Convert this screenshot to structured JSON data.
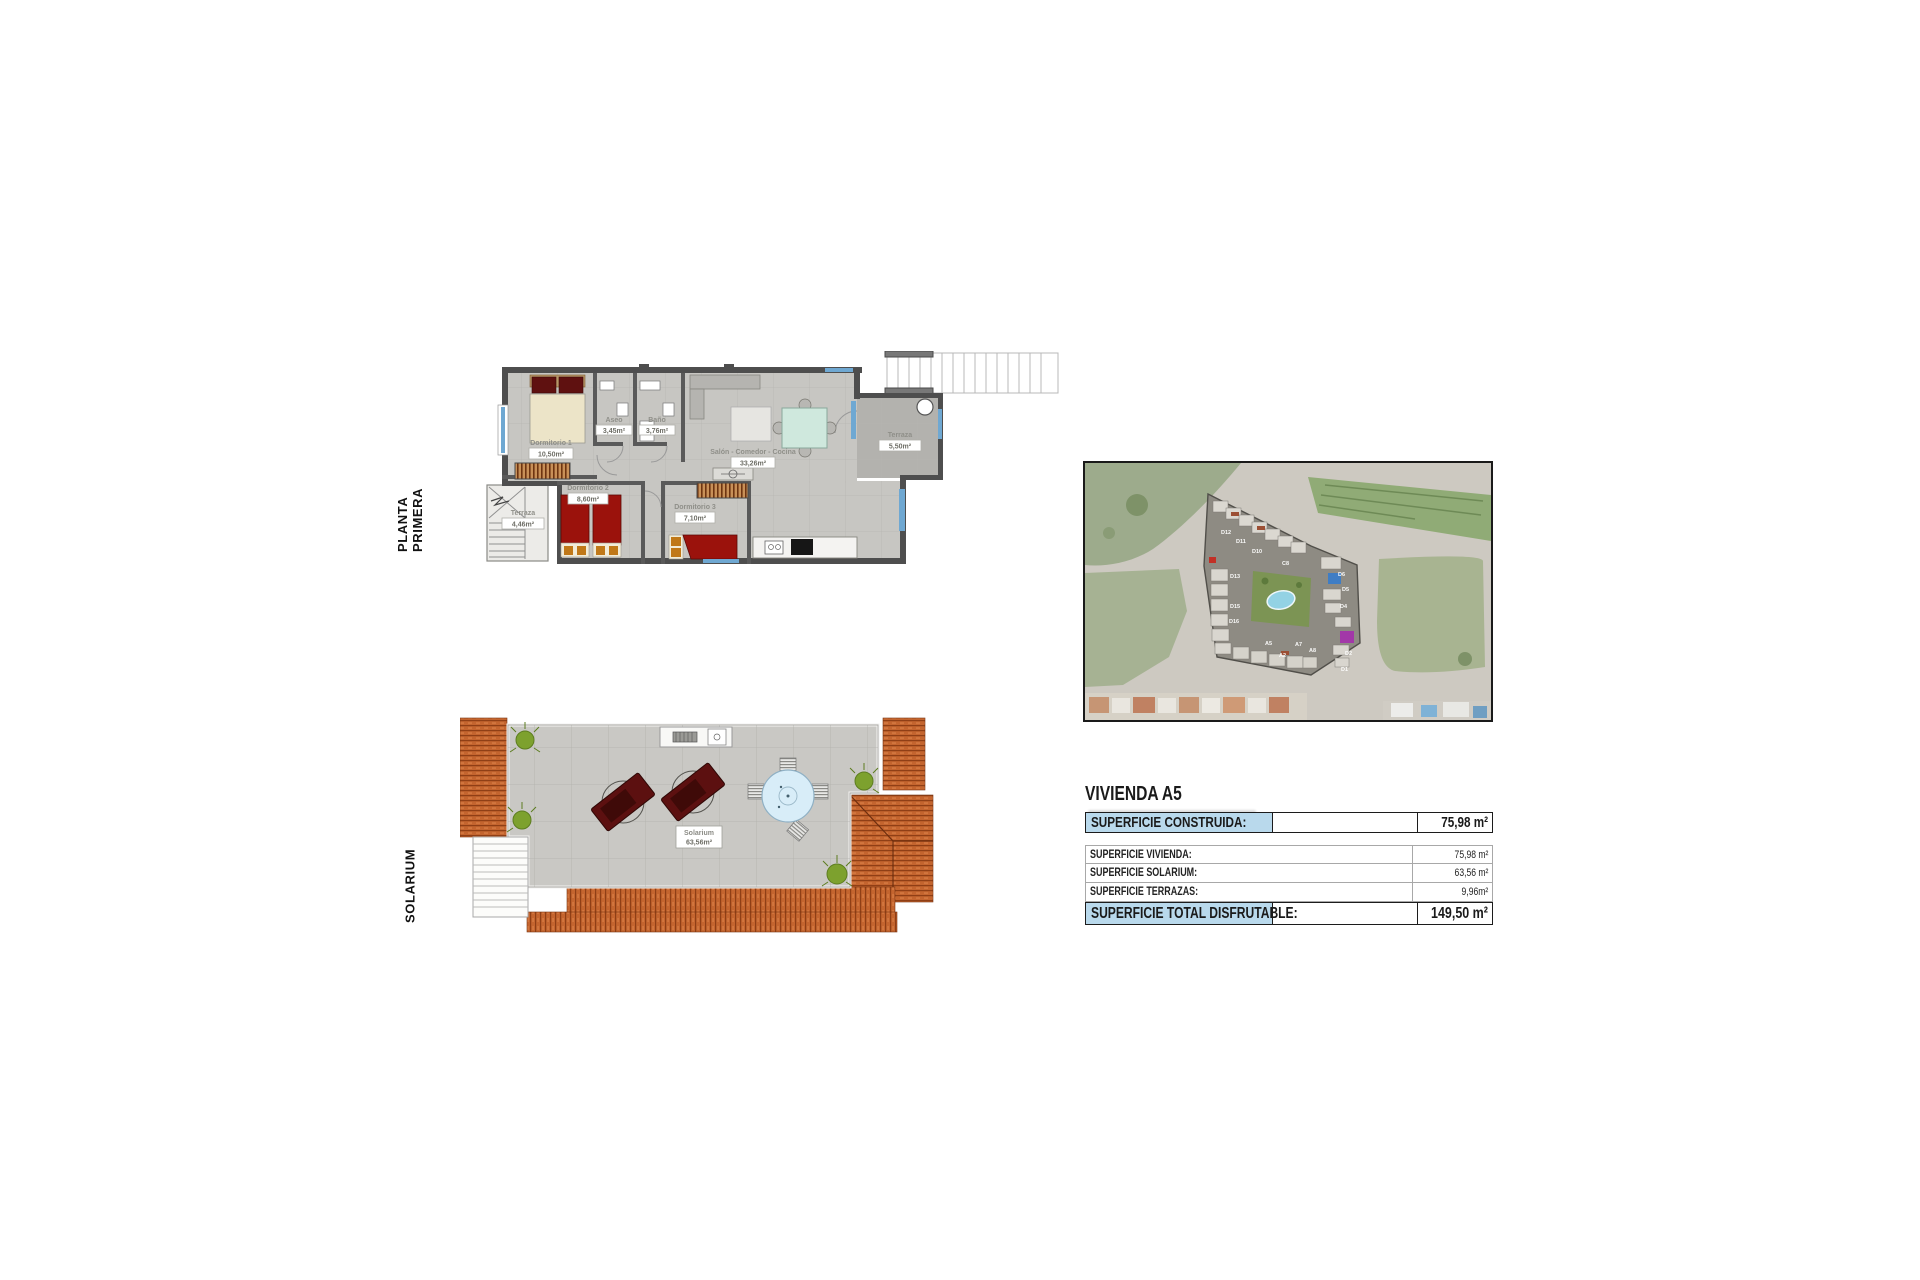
{
  "page": {
    "background": "#ffffff"
  },
  "plans": {
    "planta_primera": {
      "side_label": "PLANTA PRIMERA",
      "rooms": [
        {
          "name": "Dormitorio 1",
          "area": "10,50m²"
        },
        {
          "name": "Aseo",
          "area": "3,45m²"
        },
        {
          "name": "Baño",
          "area": "3,76m²"
        },
        {
          "name": "Salón - Comedor - Cocina",
          "area": "33,26m²"
        },
        {
          "name": "Terraza",
          "area": "5,50m²"
        },
        {
          "name": "Terraza",
          "area": "4,46m²"
        },
        {
          "name": "Dormitorio 2",
          "area": "8,60m²"
        },
        {
          "name": "Dormitorio 3",
          "area": "7,10m²"
        }
      ]
    },
    "solarium": {
      "side_label": "SOLARIUM",
      "room": {
        "name": "Solarium",
        "area": "63,56m²"
      }
    }
  },
  "site_map": {
    "building_labels": [
      {
        "t": "D12"
      },
      {
        "t": "D11"
      },
      {
        "t": "D10"
      },
      {
        "t": "C8"
      },
      {
        "t": "D13"
      },
      {
        "t": "D15"
      },
      {
        "t": "D16"
      },
      {
        "t": "A5"
      },
      {
        "t": "A2"
      },
      {
        "t": "A7"
      },
      {
        "t": "A8"
      },
      {
        "t": "D6"
      },
      {
        "t": "D5"
      },
      {
        "t": "D4"
      },
      {
        "t": "D2"
      },
      {
        "t": "D1"
      }
    ]
  },
  "summary": {
    "title": "VIVIENDA A5",
    "rows": [
      {
        "label": "SUPERFICIE CONSTRUIDA:",
        "value": "75,98 m²",
        "emphasis": true
      },
      {
        "label": "SUPERFICIE VIVIENDA:",
        "value": "75,98 m²",
        "emphasis": false
      },
      {
        "label": "SUPERFICIE SOLARIUM:",
        "value": "63,56 m²",
        "emphasis": false
      },
      {
        "label": "SUPERFICIE TERRAZAS:",
        "value": "9,96m²",
        "emphasis": false
      },
      {
        "label": "SUPERFICIE TOTAL DISFRUTABLE:",
        "value": "149,50 m²",
        "emphasis": true
      }
    ]
  },
  "colors": {
    "highlight_blue": "#b9d9ec",
    "terracotta_roof": "#c4652f",
    "bed_red": "#9b120c",
    "window_blue": "#6fa8d2",
    "pool_blue": "#93d2e4",
    "floor_gray": "#c7c6c2"
  }
}
